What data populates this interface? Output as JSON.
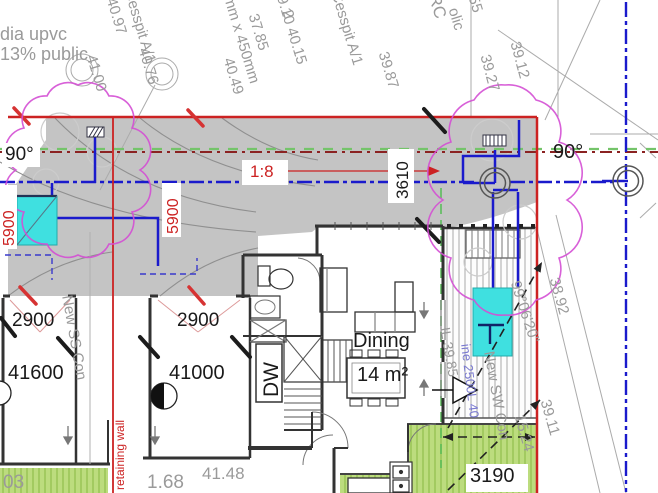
{
  "drawing": {
    "room": {
      "name": "Dining",
      "area": "14 m²"
    },
    "dims": {
      "d2900_left": "2900",
      "d41600": "41600",
      "d2900_mid": "2900",
      "d41000": "41000",
      "d3610": "3610",
      "d5900_left": "5900",
      "d5900_mid": "5900",
      "d3190": "3190",
      "ratio": "1:8",
      "angle_left": "90°",
      "angle_right": "90°"
    },
    "notes": {
      "dia_upvc": "dia upvc",
      "public": "13% public",
      "cesspit1": "Cesspit A/1",
      "cesspit2": "Cesspit A/1",
      "size450": "450mm x 450mm",
      "new_ss_con": "New SS Con",
      "new_sw_con": "New SW Con",
      "retaining_wall": "retaining wall",
      "dw": "DW",
      "tank_line": "ine 2500L 40",
      "il_level": "IL 39.85"
    },
    "levels": {
      "l4097": "40.97",
      "l4100": "41.00",
      "l4076": "40.76",
      "l3910_4015": "39.10  40.15",
      "l3785": "37.85",
      "l2": "2",
      "l3987": "39.87",
      "l4049": "40.49",
      "lrc": "RC",
      "lolic": "olic",
      "l55": "55",
      "l3912": "39.12",
      "l3927": "39.27",
      "l3892": "38.92",
      "l99": "99°06'20\"",
      "l1524": "15.24",
      "l3911": "39.11",
      "l4148": "41.48",
      "l168": "1.68",
      "l03": "03"
    },
    "colors": {
      "boundary_red": "#cc2222",
      "drainage_blue": "#1a1acc",
      "cloud_magenta": "#d44fd4",
      "tank_cyan": "#3fe0e0",
      "lawn_green": "#bcdc7e",
      "driveway_grey": "#c4c4c4",
      "survey_grey": "#9a9a9a"
    }
  }
}
